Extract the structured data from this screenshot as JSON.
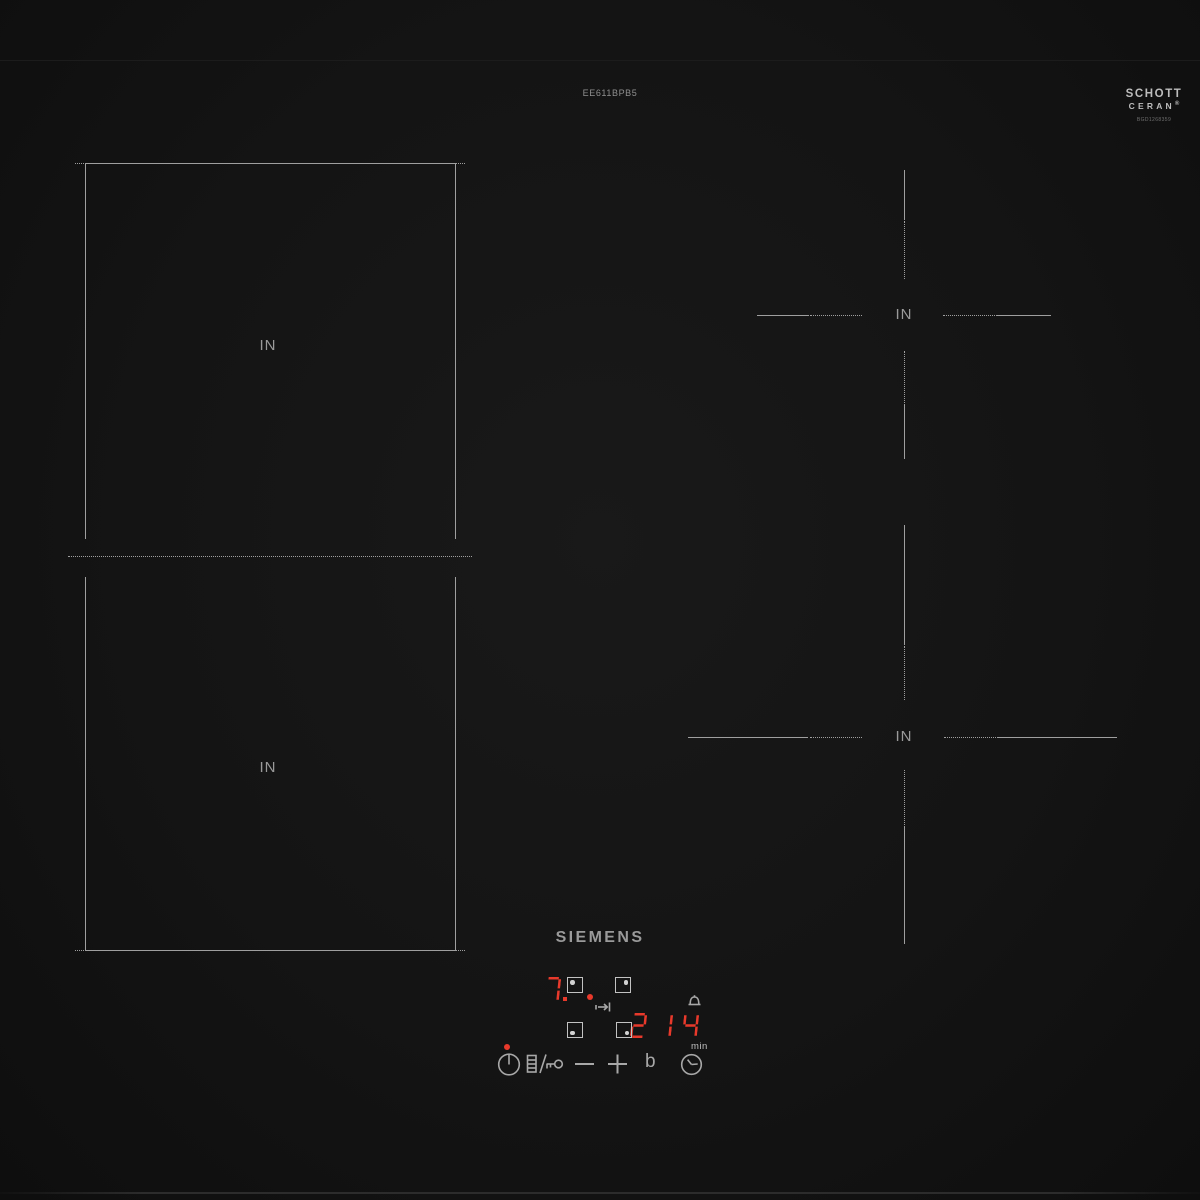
{
  "colors": {
    "surface": "#141414",
    "line_gray": "#9f9f9f",
    "bright_gray": "#c2c2c2",
    "text_gray": "#949494",
    "display_red": "#e8392b"
  },
  "header": {
    "model_number": "EE611BPB5"
  },
  "schott": {
    "line1": "SCHOTT",
    "line2": "CERAN",
    "registered": "®",
    "code": "BGD1268359"
  },
  "brand": {
    "logo_text": "SIEMENS"
  },
  "zones": {
    "flex_top_label": "IN",
    "flex_bottom_label": "IN",
    "rear_right_label": "IN",
    "front_right_label": "IN"
  },
  "display": {
    "left_zone_level": "7.",
    "right_zone_level": "2",
    "timer_value": "14",
    "timer_unit": "min",
    "booster_label": "b"
  },
  "icons": {
    "power": "power-icon",
    "wipe_lock": "wipe-protection-key-icon",
    "minus": "minus-icon",
    "plus": "plus-icon",
    "timer_clock": "clock-icon",
    "timer_alarm": "bell-icon",
    "move_pot": "move-pot-arrow-icon"
  }
}
